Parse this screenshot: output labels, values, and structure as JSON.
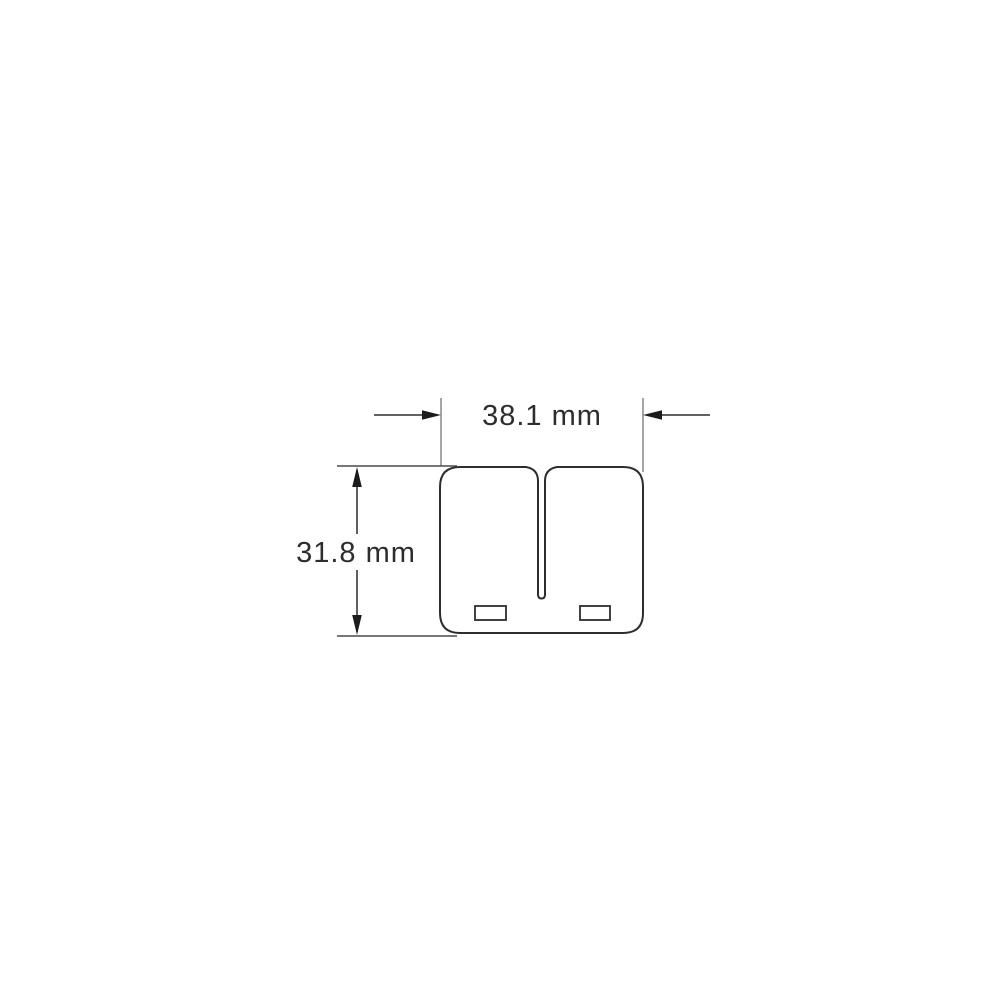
{
  "diagram": {
    "type": "technical-dimension-drawing",
    "subject": "reed-valve-petal-outline",
    "dimensions": {
      "width_label": "38.1 mm",
      "height_label": "31.8 mm"
    },
    "colors": {
      "line": "#2d2d2d",
      "extension_line_gray": "#9b9b9b",
      "extension_line_dark": "#4a4a4a",
      "arrow": "#1c1c1c",
      "background": "#ffffff"
    }
  }
}
